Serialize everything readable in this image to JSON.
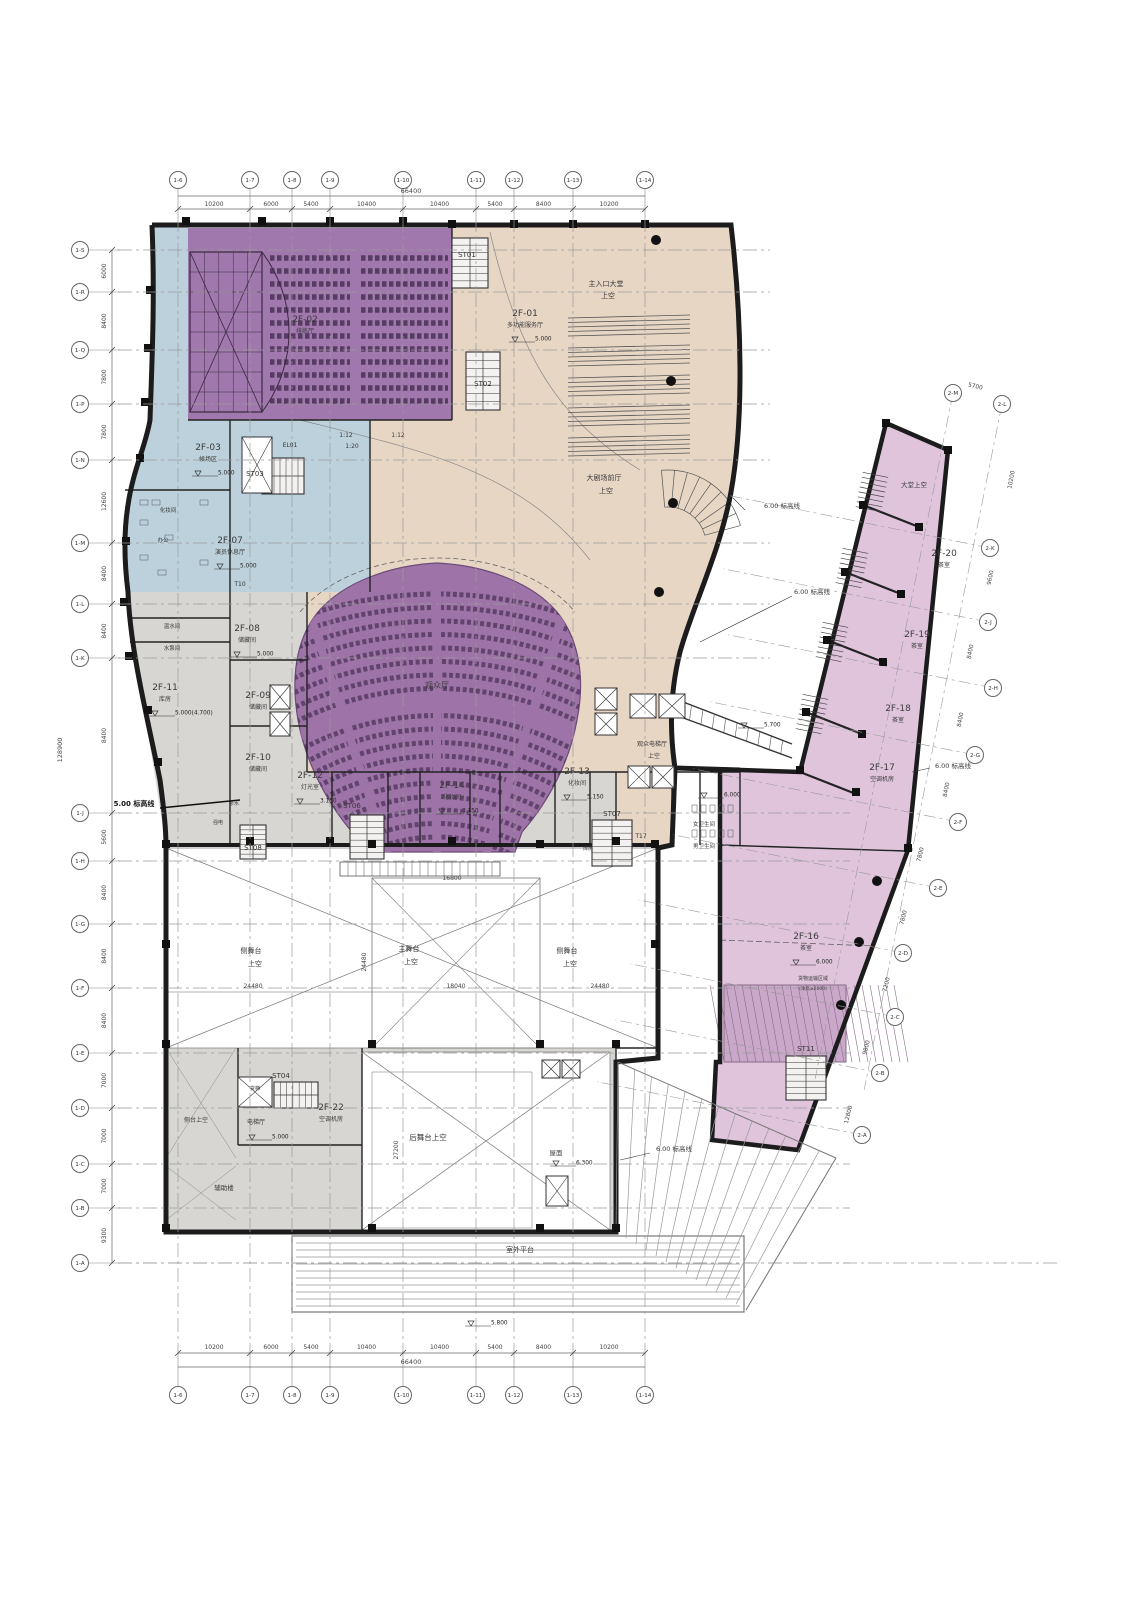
{
  "colors": {
    "purple_zone": "#a078ad",
    "fan_zone": "#9e74a8",
    "seat": "#563b63",
    "blue_zone": "#bcd1dc",
    "beige_zone": "#e8d6c5",
    "gray_zone": "#d8d6d3",
    "pink_zone": "#dfc4dc",
    "pink_hatch": "#caa8c9",
    "wall": "#1c1c1c",
    "grid_line": "#9a9a9a",
    "dim_text": "#444444",
    "void_white": "#ffffff"
  },
  "grid": {
    "top_labels": [
      "1-6",
      "1-7",
      "1-8",
      "1-9",
      "1-10",
      "1-11",
      "1-12",
      "1-13",
      "1-14"
    ],
    "bottom_labels": [
      "1-6",
      "1-7",
      "1-8",
      "1-9",
      "1-10",
      "1-11",
      "1-12",
      "1-13",
      "1-14"
    ],
    "left_labels": [
      "1-S",
      "1-R",
      "1-Q",
      "1-P",
      "1-N",
      "1-M",
      "1-L",
      "1-K",
      "1-J",
      "1-H",
      "1-G",
      "1-F",
      "1-E",
      "1-D",
      "1-C",
      "1-B",
      "1-A"
    ],
    "wing_labels": [
      "2-M",
      "2-L",
      "2-K",
      "2-J",
      "2-H",
      "2-G",
      "2-F",
      "2-E",
      "2-D",
      "2-C",
      "2-B",
      "2-A"
    ],
    "top_dims": [
      "10200",
      "6000",
      "5400",
      "10400",
      "10400",
      "5400",
      "8400",
      "10200"
    ],
    "top_total": "66400",
    "bottom_dims": [
      "10200",
      "6000",
      "5400",
      "10400",
      "10400",
      "5400",
      "8400",
      "10200"
    ],
    "bottom_total": "66400",
    "left_dims": [
      "6000",
      "8400",
      "7800",
      "7800",
      "12600",
      "8400",
      "8400",
      "8400",
      "5600",
      "8400",
      "8400",
      "8400",
      "7000",
      "7000",
      "7000",
      "9300"
    ],
    "left_total": "128900",
    "wing_dims": [
      "5700",
      "10200",
      "9600",
      "8400",
      "8400",
      "8400",
      "7800",
      "7800",
      "7200",
      "9800",
      "12800"
    ]
  },
  "rooms": {
    "2F-01": {
      "id": "2F-01",
      "name": "多功能服务厅",
      "elev": "5.000"
    },
    "2F-02": {
      "id": "2F-02",
      "name": "排练厅",
      "elev": ""
    },
    "2F-03": {
      "id": "2F-03",
      "name": "候场区",
      "elev": "5.000"
    },
    "2F-07": {
      "id": "2F-07",
      "name": "演员休息厅",
      "elev": "5.000"
    },
    "2F-08": {
      "id": "2F-08",
      "name": "储藏间",
      "elev": "5.000"
    },
    "2F-09": {
      "id": "2F-09",
      "name": "储藏间",
      "elev": ""
    },
    "2F-10": {
      "id": "2F-10",
      "name": "储藏间",
      "elev": ""
    },
    "2F-11": {
      "id": "2F-11",
      "name": "库房",
      "elev": "5.000(4.700)"
    },
    "2F-12": {
      "id": "2F-12",
      "name": "灯光室",
      "elev": "3.150"
    },
    "2F-13": {
      "id": "2F-13",
      "name": "化妆间",
      "elev": "5.150"
    },
    "2F-14": {
      "id": "2F-14",
      "name": "化妆间",
      "elev": "3.150"
    },
    "2F-16": {
      "id": "2F-16",
      "name": "茶室",
      "elev": "6.000"
    },
    "2F-17": {
      "id": "2F-17",
      "name": "空调机房",
      "elev": ""
    },
    "2F-18": {
      "id": "2F-18",
      "name": "茶室",
      "elev": ""
    },
    "2F-19": {
      "id": "2F-19",
      "name": "茶室",
      "elev": ""
    },
    "2F-20": {
      "id": "2F-20",
      "name": "茶室",
      "elev": ""
    },
    "2F-22": {
      "id": "2F-22",
      "name": "空调机房",
      "elev": ""
    }
  },
  "cores": {
    "stairs": [
      "ST01",
      "ST02",
      "ST03",
      "ST04",
      "ST06",
      "ST07",
      "ST08",
      "ST11"
    ],
    "toilets": [
      "T10",
      "T17"
    ],
    "elevators": [
      "EL01"
    ]
  },
  "annotations": {
    "main_entry_1": "主入口大堂",
    "main_entry_2": "上空",
    "foyer_1": "大剧场前厅",
    "foyer_2": "上空",
    "audience_hall": "观众厅",
    "elev_hall_1": "观众电梯厅",
    "elev_hall_2": "上空",
    "stage_l1": "侧舞台",
    "stage_l2": "上空",
    "stage_m1": "主舞台",
    "stage_m2": "上空",
    "stage_r1": "侧舞台",
    "stage_r2": "上空",
    "rear_void": "后舞台上空",
    "side_void": "侧台上空",
    "wing_void": "大堂上空",
    "roof": "屋面",
    "terrace": "室外平台",
    "aux": "辅助楼",
    "elev_lobby": "电梯厅",
    "freight": "货梯",
    "pump": "水泵间",
    "hotwater": "温水间",
    "strong_elec": "强电",
    "tea": "茶水",
    "store": "库房",
    "wc_f": "女卫生间",
    "wc_m": "男卫生间",
    "dressing": "化妆间",
    "office": "办公",
    "cargo1": "货物运输区域",
    "cargo2": "(净高≥2600)",
    "line5": "5.00 标高线",
    "line6a": "6.00 标高线",
    "line6b": "6.00 标高线",
    "line6c": "6.00 标高线",
    "line6d": "6.00 标高线",
    "slope1": "1:12",
    "slope2": "1:12",
    "slope3": "1:20"
  },
  "elev_marks": [
    "6.000",
    "5.000",
    "6.300",
    "5.800",
    "5.700"
  ],
  "void_dims": [
    "24480",
    "18040",
    "24480",
    "16800",
    "24480",
    "27200"
  ]
}
